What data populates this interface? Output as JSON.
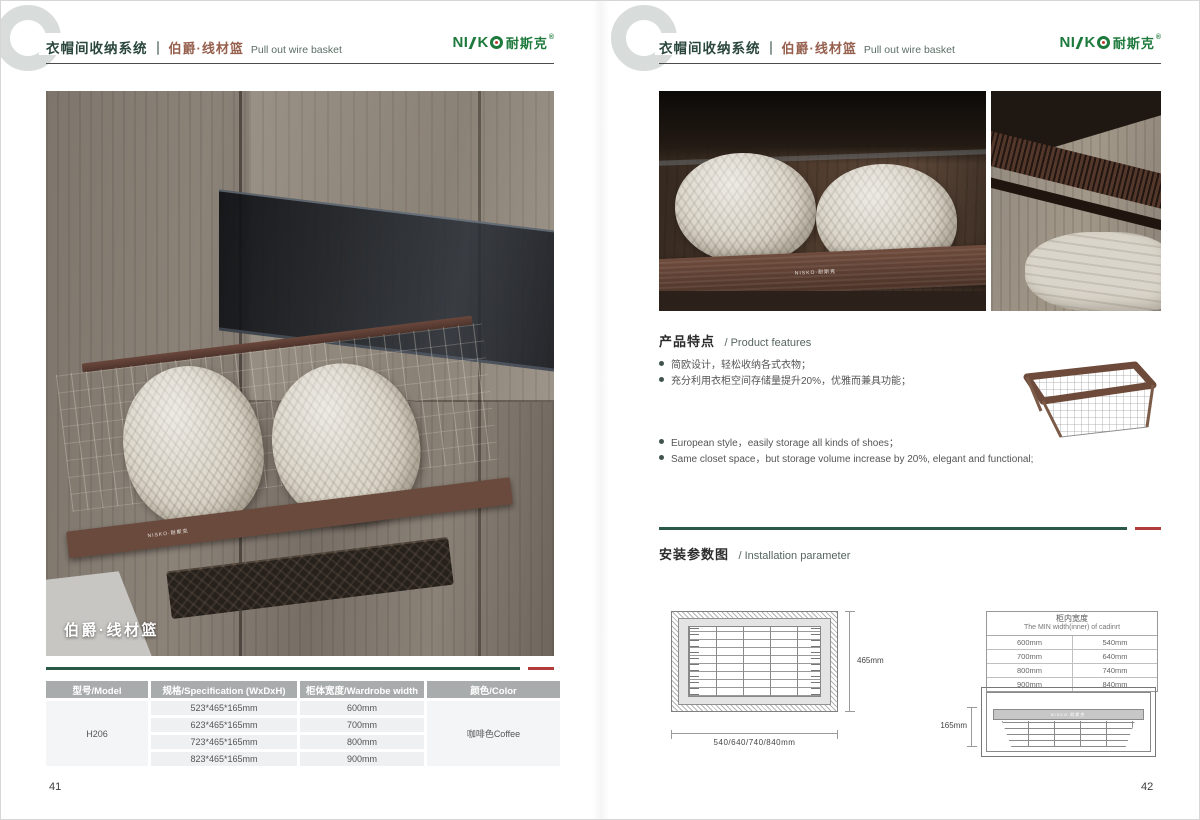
{
  "brand": {
    "part1": "NI",
    "part2": "K",
    "cn": "耐斯克",
    "reg": "®",
    "watermark": "NISKO·耐斯克"
  },
  "header": {
    "title_cn": "衣帽间收纳系统",
    "separator": "｜",
    "subtitle_cn": "伯爵·线材篮",
    "subtitle_en": "Pull out wire basket"
  },
  "left_page": {
    "photo_caption": "伯爵·线材篮",
    "page_number": "41",
    "table": {
      "headers": [
        "型号/Model",
        "规格/Specification (WxDxH)",
        "柜体宽度/Wardrobe width",
        "颜色/Color"
      ],
      "model": "H206",
      "color": "咖啡色Coffee",
      "rows": [
        {
          "spec": "523*465*165mm",
          "width": "600mm"
        },
        {
          "spec": "623*465*165mm",
          "width": "700mm"
        },
        {
          "spec": "723*465*165mm",
          "width": "800mm"
        },
        {
          "spec": "823*465*165mm",
          "width": "900mm"
        }
      ]
    }
  },
  "right_page": {
    "page_number": "42",
    "features": {
      "title_cn": "产品特点",
      "title_en": "/ Product features",
      "bullets_cn": [
        "简欧设计，轻松收纳各式衣物；",
        "充分利用衣柜空间存储量提升20%，优雅而兼具功能；"
      ],
      "bullets_en": [
        "European style，easily storage all kinds of shoes；",
        "Same closet space，but storage volume increase by 20%, elegant and functional;"
      ]
    },
    "installation": {
      "title_cn": "安装参数图",
      "title_en": "/ Installation parameter",
      "top_view": {
        "depth_label": "465mm",
        "width_label": "540/640/740/840mm"
      },
      "side_view": {
        "height_label": "165mm"
      },
      "min_width_table": {
        "title_cn": "柜内宽度",
        "title_en": "The MIN width(inner) of cadinrt",
        "col_rows": [
          [
            "600mm",
            "540mm"
          ],
          [
            "700mm",
            "640mm"
          ],
          [
            "800mm",
            "740mm"
          ],
          [
            "900mm",
            "840mm"
          ]
        ]
      }
    }
  }
}
